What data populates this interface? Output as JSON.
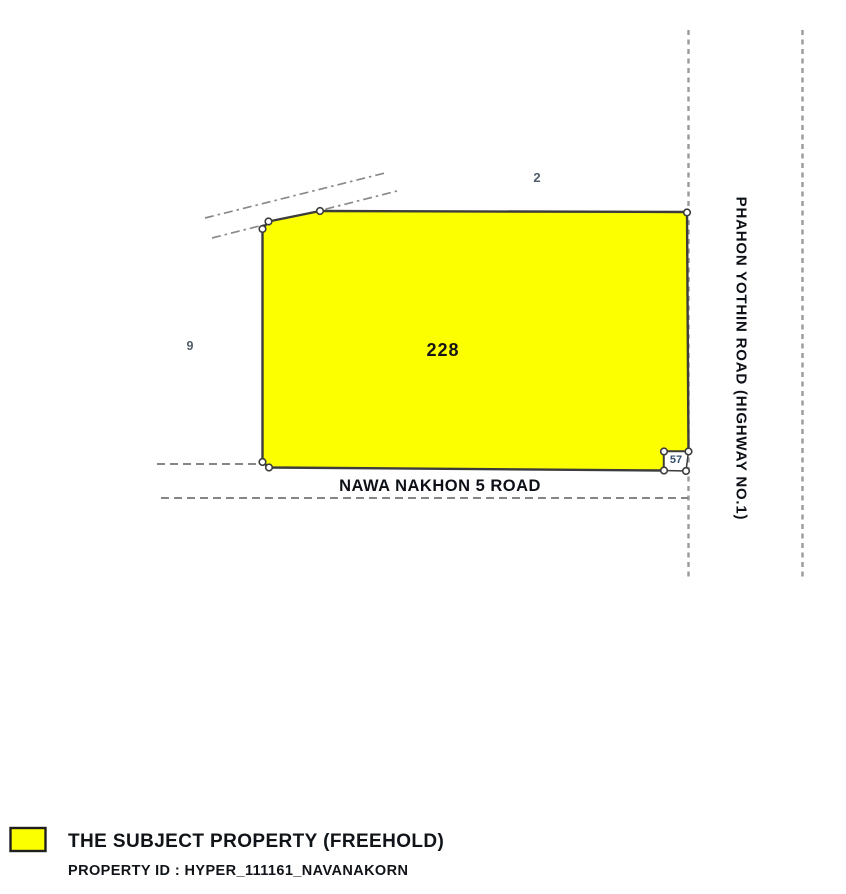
{
  "diagram": {
    "parcel_labels": {
      "subject": "228",
      "north_parcel": "2",
      "west_parcel": "9",
      "corner_parcel": "57"
    },
    "roads": {
      "east_road": "PHAHON YOTHIN ROAD (HIGHWAY NO.1)",
      "south_road": "NAWA NAKHON 5 ROAD"
    },
    "colors": {
      "subject_fill": "#FCFF00",
      "outline": "#3C3C3C",
      "dashed_line": "#9A9A9A",
      "adjacent_label_text": "#515E6B",
      "road_text": "#0D1117"
    }
  },
  "legend": {
    "swatch_color": "#FCFF00",
    "title": "THE SUBJECT PROPERTY (FREEHOLD)",
    "property_id": "PROPERTY ID : HYPER_111161_NAVANAKORN"
  }
}
